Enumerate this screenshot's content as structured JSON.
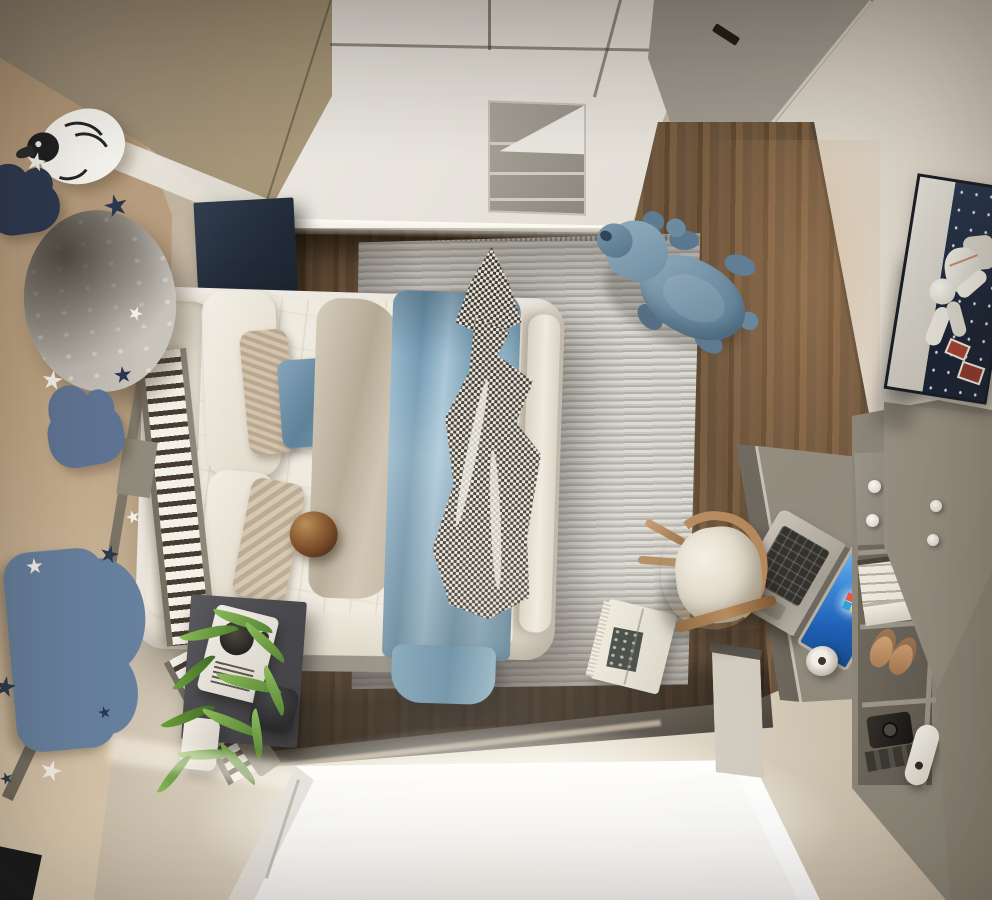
{
  "scene": {
    "title": "Top-down 3D render of a child's bedroom",
    "view": "bird's-eye interior render, no visible text",
    "objects": [
      {
        "id": "left-wall",
        "label": "beige accent wall with decals"
      },
      {
        "id": "moon-decor",
        "label": "round moon wall lamp"
      },
      {
        "id": "bird-decor",
        "label": "white bird line-art wall decor"
      },
      {
        "id": "cloud-decals",
        "label": "navy and blue cloud wall decals"
      },
      {
        "id": "star-decals",
        "label": "white and navy star wall decals"
      },
      {
        "id": "wardrobe",
        "label": "white wardrobe with open shelf niche, seen from above"
      },
      {
        "id": "mirror-panels",
        "label": "mirrored wardrobe panels, top left"
      },
      {
        "id": "ceiling-panel",
        "label": "grey ceiling band, top right"
      },
      {
        "id": "right-wall",
        "label": "cream right wall"
      },
      {
        "id": "astronaut-art",
        "label": "framed astronaut poster"
      },
      {
        "id": "navy-cabinet",
        "label": "dark navy headboard cabinet"
      },
      {
        "id": "bed",
        "label": "upholstered bed with pillows, duvet, blue blanket, checkered throw"
      },
      {
        "id": "guard-rail",
        "label": "white slatted bed guard rail with grey frame"
      },
      {
        "id": "rug",
        "label": "grey striped area rug"
      },
      {
        "id": "plush-toy",
        "label": "blue hippo plush toy on rug"
      },
      {
        "id": "book",
        "label": "open book lying on rug"
      },
      {
        "id": "wood-floor",
        "label": "dark walnut plank floor"
      },
      {
        "id": "beige-floor",
        "label": "light beige floor area"
      },
      {
        "id": "skylight",
        "label": "bright recessed light well / window with blinds"
      },
      {
        "id": "nightstand",
        "label": "dark grey bedside cabinet"
      },
      {
        "id": "radio",
        "label": "white retro radio on nightstand"
      },
      {
        "id": "plant",
        "label": "green leafy plant in white pot"
      },
      {
        "id": "desk",
        "label": "grey desk"
      },
      {
        "id": "laptop",
        "label": "open laptop with blue wallpaper screen"
      },
      {
        "id": "charger",
        "label": "round desk charger puck"
      },
      {
        "id": "chair",
        "label": "wooden chair with cream seat"
      },
      {
        "id": "shelf-unit",
        "label": "grey shelf unit with books, slippers, camera, remote"
      },
      {
        "id": "angled-panels",
        "label": "slanted grey wardrobe doors, right side"
      }
    ],
    "palette": {
      "wall_beige": "#c2a988",
      "wall_cream": "#e9e3d8",
      "ceiling_grey": "#a19a90",
      "wardrobe_white": "#e9e6e0",
      "seam_dark": "#4a443c",
      "niche_grey": "#99948a",
      "navy_decor": "#2c3850",
      "cloud_blue_mid": "#5f7494",
      "cloud_blue_big": "#67809f",
      "star_white": "#f4f1ea",
      "star_navy": "#2c3850",
      "moon_grey": "#b8b3ab",
      "headboard_navy": "#273140",
      "wood_mid": "#6b5239",
      "wood_dark": "#3a2e22",
      "rug_light": "#d9d7d1",
      "rug_dark": "#b7b4ad",
      "bed_frame": "#e7e1d5",
      "duvet_white": "#efebe1",
      "pillow_beige": "#c4b29c",
      "pillow_blue": "#6f93ab",
      "throw_taupe": "#c5bba9",
      "blanket_blue": "#7fa3ba",
      "check_dark": "#3b362e",
      "check_light": "#ece8de",
      "ball_brown": "#6b4526",
      "rail_slat": "#f3f0e8",
      "rail_gap": "#463d32",
      "rail_frame": "#8d8779",
      "nightstand_grey": "#46464b",
      "radio_white": "#e9e6df",
      "plant_green": "#6f9c42",
      "floor_beige": "#c9bdab",
      "skylight_white": "#ffffff",
      "teddy_blue": "#7e99ac",
      "teddy_dark": "#56748c",
      "desk_grey": "#9a9287",
      "laptop_silver": "#b9b3a8",
      "screen_blue": "#2f74cf",
      "keyboard_dark": "#34322d",
      "chair_wood": "#b5895c",
      "chair_seat": "#e9e2d3",
      "shelf_grey": "#8c8679",
      "book_white": "#e8e4d8",
      "slipper_tan": "#cfa27b",
      "camera_black": "#24221f",
      "art_navy": "#202c3f",
      "art_grey": "#d7d3cb",
      "astronaut_white": "#eceae3",
      "pot_black": "#1c1d20",
      "corner_black": "#17181a"
    }
  }
}
